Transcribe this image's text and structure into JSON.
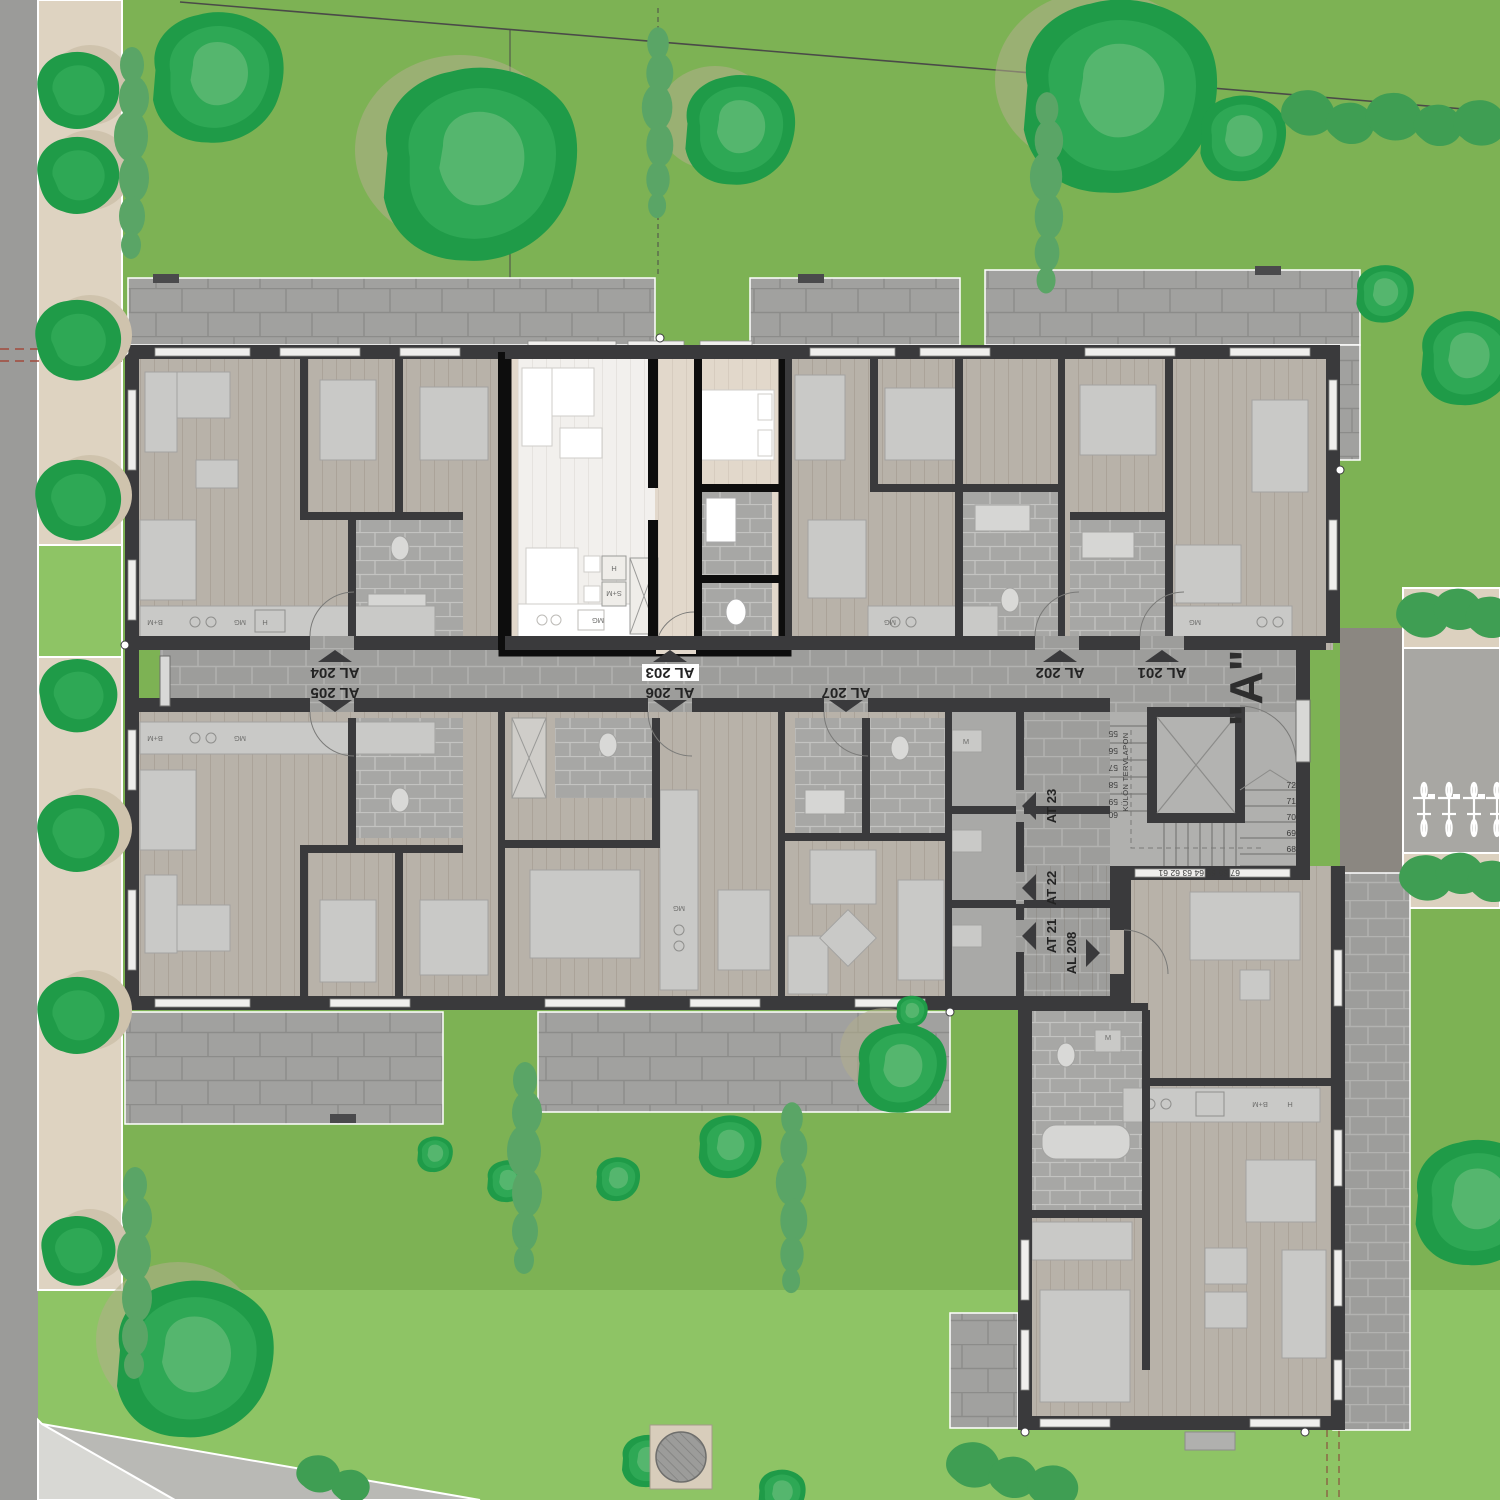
{
  "plan": {
    "entrance": "\"A\"",
    "stair_note": "KÜLÖN TERVLAPON",
    "corridor_units": [
      {
        "id": "AL 204",
        "arrow": "up"
      },
      {
        "id": "AL 205",
        "arrow": "down"
      },
      {
        "id": "AL 203",
        "arrow": "up",
        "highlighted": true
      },
      {
        "id": "AL 206",
        "arrow": "down"
      },
      {
        "id": "AL 207",
        "arrow": "down"
      },
      {
        "id": "AL 202",
        "arrow": "up"
      },
      {
        "id": "AL 201",
        "arrow": "up"
      }
    ],
    "storage_units": [
      {
        "id": "AT23",
        "arrow": "left"
      },
      {
        "id": "AT22",
        "arrow": "left"
      },
      {
        "id": "AT21",
        "arrow": "left"
      },
      {
        "id": "AL 208",
        "arrow": "right"
      }
    ]
  },
  "labels": {
    "al201": "AL 201",
    "al202": "AL 202",
    "al203": "AL 203",
    "al204": "AL 204",
    "al205": "AL 205",
    "al206": "AL 206",
    "al207": "AL 207",
    "al208": "AL 208",
    "at21": "AT 21",
    "at22": "AT 22",
    "at23": "AT 23",
    "entrance": "\"A\"",
    "note": "KÜLÖN TERVLAPON"
  },
  "stairs": {
    "right": [
      "72",
      "71",
      "70",
      "69",
      "68"
    ],
    "left": [
      "55",
      "56",
      "57",
      "58",
      "59",
      "60"
    ],
    "bottom": [
      "61",
      "62",
      "63",
      "64",
      "65",
      "66",
      "67"
    ]
  },
  "tags": {
    "mg": "MG",
    "h": "H",
    "sm": "S+M",
    "bm": "B+M",
    "m": "M"
  },
  "colors": {
    "grass": "#7db254",
    "grass_light": "#8ec465",
    "path_beige": "#ded3c1",
    "road_left": "#9b9b99",
    "road_right": "#a8a7a3",
    "driveway": "#8b8781",
    "paver": "#a1a19f",
    "corridor_brick": "#9d9d9b",
    "wall": "#3a3a3c",
    "wall_highlight": "#0d0d0d",
    "floor": "#b8b2a9",
    "floor_highlight": "#e2d8cb",
    "floor_white": "#f2f0ed",
    "tree_green": "#2ea855"
  }
}
